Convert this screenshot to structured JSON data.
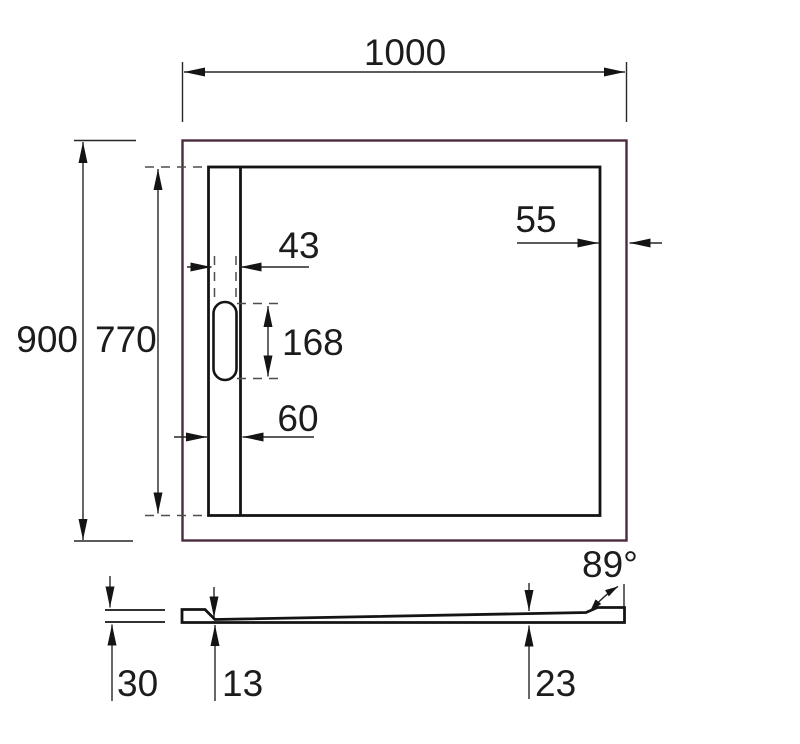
{
  "title": "Shower tray technical drawing",
  "colors": {
    "tray_outer_edge": "#4a2a3f",
    "drawing_line": "#141414",
    "dimension_line": "#262626",
    "text": "#1c1c1c",
    "background": "#ffffff"
  },
  "top_view": {
    "overall_width": "1000",
    "overall_depth": "900",
    "inner_depth": "770",
    "right_edge_inset": "55",
    "slot_width": "43",
    "slot_length": "168",
    "channel_width": "60"
  },
  "side_view": {
    "edge_height": "30",
    "base_thickness": "13",
    "right_end_thickness": "23",
    "wall_angle": "89°"
  }
}
